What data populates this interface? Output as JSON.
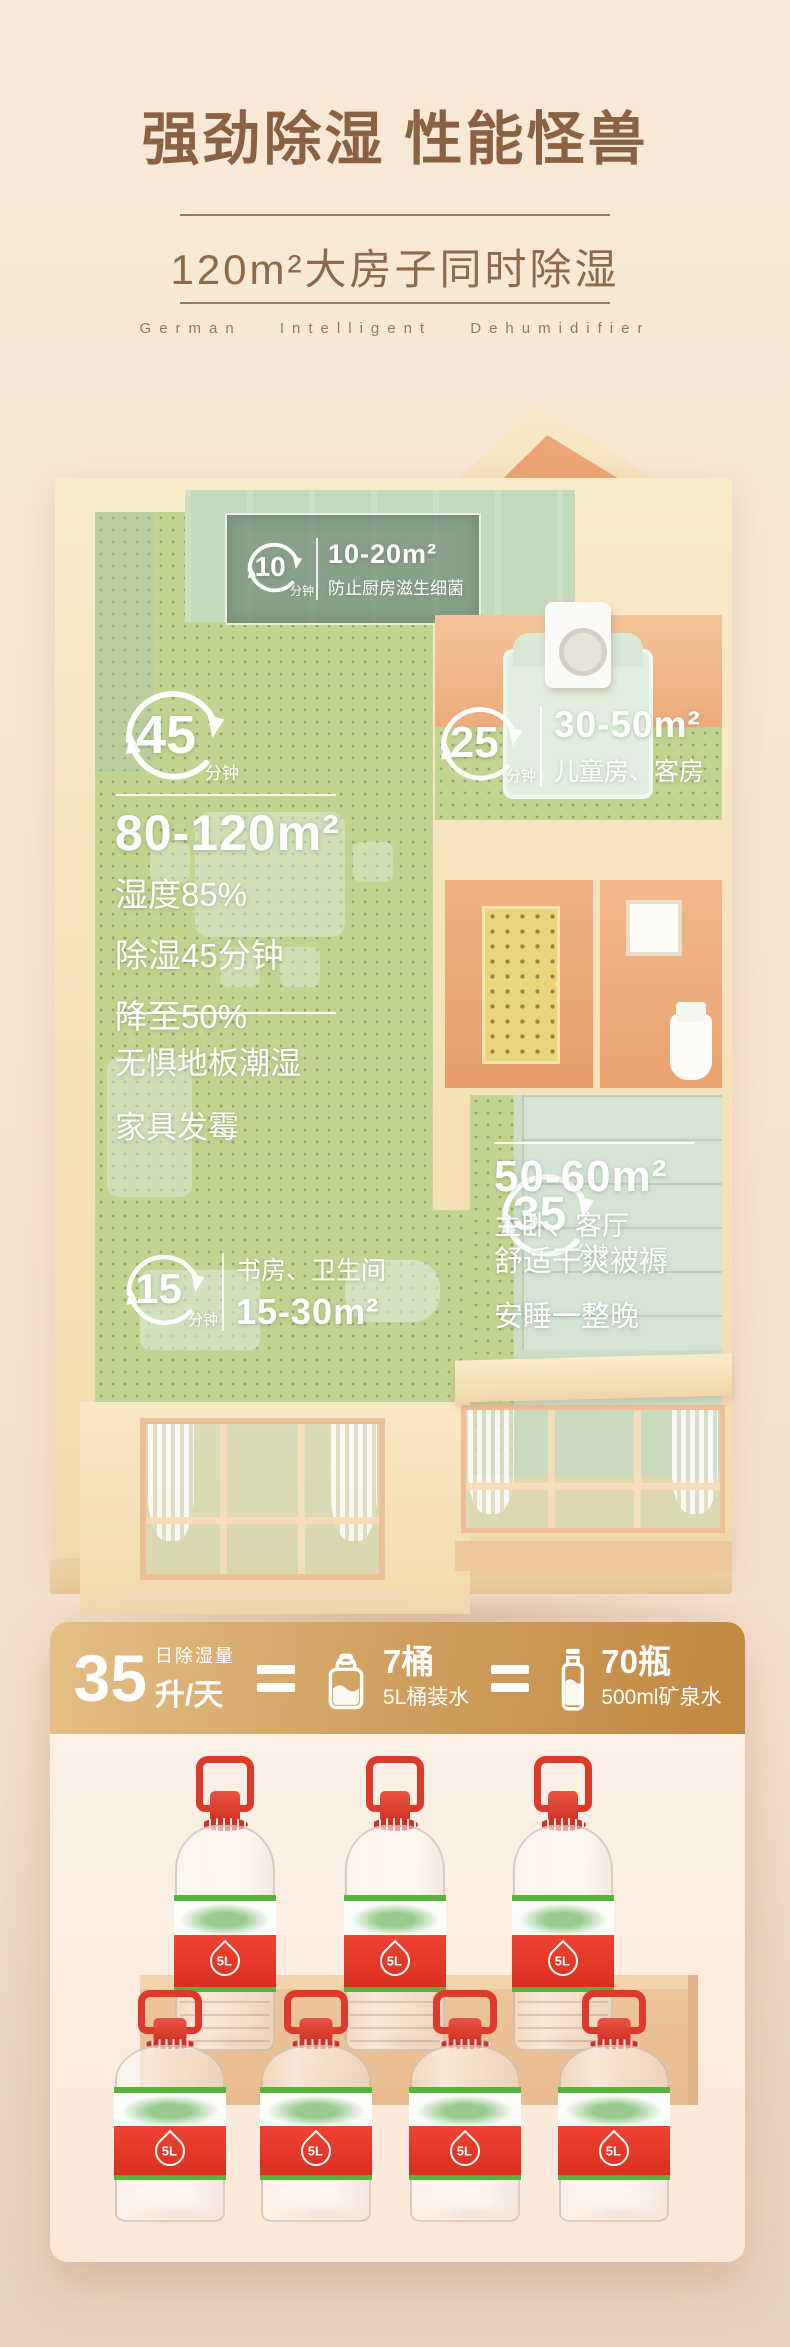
{
  "header": {
    "title": "强劲除湿 性能怪兽",
    "subtitle": "120m²大房子同时除湿",
    "tagline": "German Intelligent Dehumidifier"
  },
  "floorplan": {
    "kitchen": {
      "minutes": "10",
      "unit": "分钟",
      "area": "10-20m²",
      "desc": "防止厨房滋生细菌"
    },
    "living": {
      "minutes": "45",
      "unit": "分钟",
      "area": "80-120m²",
      "stat1": "湿度85%",
      "stat2": "除湿45分钟",
      "stat3": "降至50%",
      "note1": "无惧地板潮湿",
      "note2": "家具发霉"
    },
    "children": {
      "minutes": "25",
      "unit": "分钟",
      "area": "30-50m²",
      "desc": "儿童房、客房"
    },
    "master": {
      "minutes": "35",
      "unit": "分钟",
      "area": "50-60m²",
      "desc": "主卧、客厅",
      "note1": "舒适干爽被褥",
      "note2": "安睡一整晚"
    },
    "study": {
      "minutes": "15",
      "unit": "分钟",
      "rooms": "书房、卫生间",
      "area": "15-30m²"
    }
  },
  "banner": {
    "value": "35",
    "label_top": "日除湿量",
    "label_bottom": "升/天",
    "buckets_count": "7桶",
    "buckets_desc": "5L桶装水",
    "bottles_count": "70瓶",
    "bottles_desc": "500ml矿泉水"
  },
  "bottles": {
    "label": "5L"
  },
  "colors": {
    "accent_red": "#de3a2b",
    "gold": "#cf9f5d",
    "brown": "#8a6243",
    "floor_green": "#cbd773"
  }
}
